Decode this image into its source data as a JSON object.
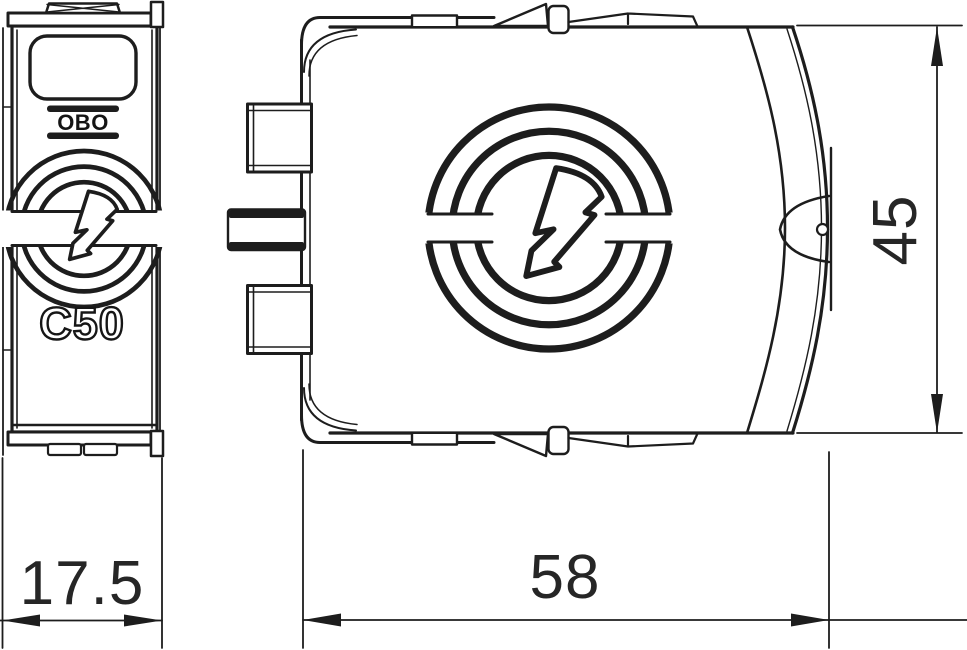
{
  "meta": {
    "background_color": "#ffffff",
    "line_color": "#1d1d1d",
    "drawing_type": "surge-protection-plug-two-view-technical-drawing"
  },
  "front_view": {
    "brand_logo": "OBO",
    "product_code": "C50"
  },
  "dimensions": {
    "front_width": "17.5",
    "side_width": "58",
    "side_height": "45"
  }
}
